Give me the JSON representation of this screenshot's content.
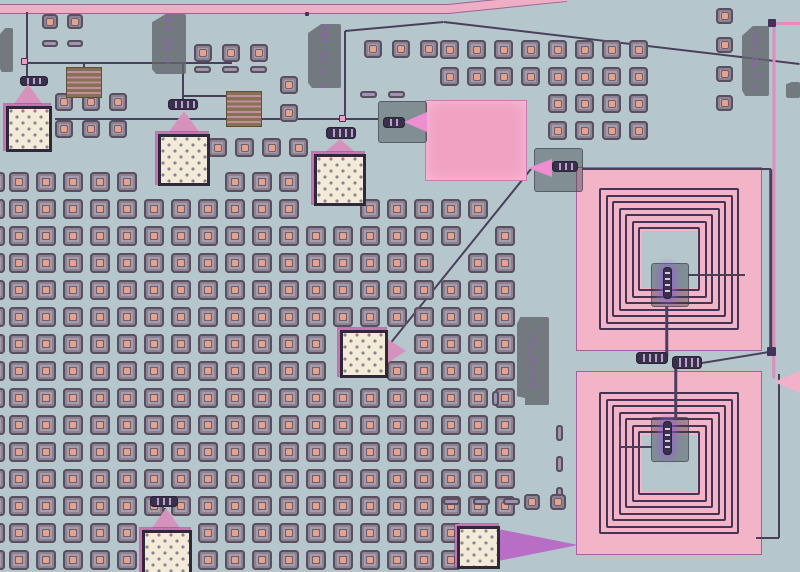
{
  "scene": {
    "kind": "chip-micrograph",
    "subject": "optical micrograph of a superconducting quantum circuit die"
  },
  "text_labels": {
    "resistor": "r = 50 ohm",
    "quad": "sq_quad"
  },
  "palette": {
    "bg": "#b5c7cd",
    "traceDark": "#4c3f5c",
    "tracePink": "#e08cbc",
    "feedPink": "#eeaec6",
    "pinkMetal": "#f3b4c7",
    "pinkRect": "#f1a2c2",
    "spiralLine": "#443557",
    "taperPink": "#d791bd",
    "taperViolet": "#b76ec4",
    "taperBright": "#ee8ed0",
    "taperPink2": "#f2b0ca",
    "padCream": "#f3ebd7",
    "padFrame": "#2e2838",
    "padRing": "#c873b4",
    "viaBody": "#756c7c",
    "viaDot": "#e7a28b",
    "tagGray": "#63676b",
    "tagText": "#8a63a8",
    "oliveResistor": "#867152"
  },
  "via_grids": [
    {
      "k": "sq",
      "x": 9,
      "y": 172,
      "dx": 27,
      "dy": 27,
      "cols": 13,
      "rows": 15,
      "w": 20,
      "h": 20,
      "skip": [
        [
          5,
          0
        ],
        [
          6,
          0
        ],
        [
          7,
          0
        ],
        [
          11,
          0
        ],
        [
          12,
          0
        ],
        [
          11,
          1
        ],
        [
          12,
          1
        ],
        [
          12,
          6
        ],
        [
          12,
          7
        ],
        [
          5,
          13
        ],
        [
          6,
          13
        ],
        [
          5,
          14
        ],
        [
          6,
          14
        ]
      ]
    },
    {
      "k": "sq",
      "x": -15,
      "y": 172,
      "dx": 27,
      "dy": 27,
      "cols": 1,
      "rows": 15,
      "w": 20,
      "h": 20,
      "skip": []
    },
    {
      "k": "sq",
      "x": 360,
      "y": 199,
      "dx": 27,
      "dy": 27,
      "cols": 6,
      "rows": 14,
      "w": 20,
      "h": 20,
      "skip": [
        [
          0,
          5
        ],
        [
          0,
          6
        ],
        [
          1,
          5
        ],
        [
          3,
          2
        ],
        [
          4,
          1
        ],
        [
          5,
          0
        ],
        [
          4,
          12
        ],
        [
          5,
          12
        ],
        [
          4,
          13
        ],
        [
          5,
          13
        ]
      ]
    },
    {
      "k": "sq",
      "x": 548,
      "y": 40,
      "dx": 27,
      "dy": 27,
      "cols": 4,
      "rows": 4,
      "w": 19,
      "h": 19,
      "skip": []
    },
    {
      "k": "sq",
      "x": 440,
      "y": 40,
      "dx": 27,
      "dy": 27,
      "cols": 4,
      "rows": 2,
      "w": 19,
      "h": 19,
      "skip": []
    },
    {
      "k": "sq",
      "x": 194,
      "y": 44,
      "dx": 28,
      "dy": 27,
      "cols": 3,
      "rows": 1,
      "w": 18,
      "h": 18,
      "skip": []
    },
    {
      "k": "bar",
      "x": 194,
      "y": 66,
      "dx": 28,
      "dy": 27,
      "cols": 3,
      "rows": 1,
      "w": 17,
      "h": 7,
      "skip": []
    },
    {
      "k": "sq",
      "x": 42,
      "y": 14,
      "dx": 25,
      "dy": 25,
      "cols": 2,
      "rows": 1,
      "w": 16,
      "h": 15,
      "skip": []
    },
    {
      "k": "bar",
      "x": 42,
      "y": 40,
      "dx": 25,
      "dy": 25,
      "cols": 2,
      "rows": 1,
      "w": 16,
      "h": 7,
      "skip": []
    },
    {
      "k": "sq",
      "x": 55,
      "y": 93,
      "dx": 27,
      "dy": 27,
      "cols": 3,
      "rows": 2,
      "w": 18,
      "h": 18,
      "skip": []
    },
    {
      "k": "sq",
      "x": 208,
      "y": 138,
      "dx": 27,
      "dy": 27,
      "cols": 4,
      "rows": 1,
      "w": 19,
      "h": 19,
      "skip": []
    },
    {
      "k": "bar",
      "x": 360,
      "y": 91,
      "dx": 28,
      "dy": 27,
      "cols": 2,
      "rows": 1,
      "w": 17,
      "h": 7,
      "skip": []
    },
    {
      "k": "sq",
      "x": 364,
      "y": 40,
      "dx": 28,
      "dy": 27,
      "cols": 3,
      "rows": 1,
      "w": 18,
      "h": 18,
      "skip": []
    },
    {
      "k": "sq",
      "x": 716,
      "y": 8,
      "dx": 27,
      "dy": 29,
      "cols": 1,
      "rows": 4,
      "w": 17,
      "h": 16,
      "skip": []
    },
    {
      "k": "vbar",
      "x": 556,
      "y": 425,
      "dx": 27,
      "dy": 31,
      "cols": 1,
      "rows": 3,
      "w": 7,
      "h": 16,
      "skip": []
    },
    {
      "k": "sq",
      "x": 280,
      "y": 76,
      "dx": 27,
      "dy": 28,
      "cols": 1,
      "rows": 2,
      "w": 18,
      "h": 18,
      "skip": []
    },
    {
      "k": "sq",
      "x": 524,
      "y": 494,
      "dx": 26,
      "dy": 27,
      "cols": 2,
      "rows": 1,
      "w": 16,
      "h": 16,
      "skip": []
    },
    {
      "k": "vbar",
      "x": 492,
      "y": 391,
      "dx": 27,
      "dy": 27,
      "cols": 1,
      "rows": 1,
      "w": 7,
      "h": 15,
      "skip": []
    },
    {
      "k": "bar",
      "x": 443,
      "y": 498,
      "dx": 30,
      "dy": 27,
      "cols": 3,
      "rows": 1,
      "w": 17,
      "h": 7,
      "skip": []
    }
  ],
  "traces_under": [
    {
      "x1": 0,
      "y1": 9,
      "x2": 449,
      "y2": 9,
      "w": 10,
      "c": "feed"
    },
    {
      "x1": 448,
      "y1": 9,
      "x2": 566,
      "y2": -3,
      "w": 10,
      "c": "feed"
    },
    {
      "x1": 26,
      "y1": 63,
      "x2": 232,
      "y2": 63,
      "w": 2,
      "c": "d"
    },
    {
      "x1": 55,
      "y1": 119,
      "x2": 378,
      "y2": 119,
      "w": 2,
      "c": "d"
    },
    {
      "x1": 345,
      "y1": 31,
      "x2": 345,
      "y2": 120,
      "w": 2,
      "c": "d"
    },
    {
      "x1": 345,
      "y1": 31,
      "x2": 444,
      "y2": 22,
      "w": 2,
      "c": "d"
    },
    {
      "x1": 444,
      "y1": 22,
      "x2": 800,
      "y2": 64,
      "w": 2,
      "c": "d"
    },
    {
      "x1": 27,
      "y1": 12,
      "x2": 27,
      "y2": 78,
      "w": 2,
      "c": "d"
    },
    {
      "x1": 183,
      "y1": 63,
      "x2": 183,
      "y2": 100,
      "w": 2,
      "c": "d"
    },
    {
      "x1": 183,
      "y1": 96,
      "x2": 228,
      "y2": 96,
      "w": 2,
      "c": "d"
    },
    {
      "x1": 84,
      "y1": 63,
      "x2": 84,
      "y2": 68,
      "w": 2,
      "c": "d"
    },
    {
      "x1": 385,
      "y1": 350,
      "x2": 531,
      "y2": 169,
      "w": 2,
      "c": "d"
    },
    {
      "x1": 165,
      "y1": 508,
      "x2": 165,
      "y2": 528,
      "w": 2,
      "c": "d"
    }
  ],
  "traces_over": [
    {
      "x1": 582,
      "y1": 169,
      "x2": 771,
      "y2": 169,
      "w": 2.5,
      "c": "d"
    },
    {
      "x1": 771,
      "y1": 169,
      "x2": 771,
      "y2": 352,
      "w": 2.5,
      "c": "d"
    },
    {
      "x1": 774,
      "y1": 23,
      "x2": 800,
      "y2": 23,
      "w": 3,
      "c": "p"
    },
    {
      "x1": 773.5,
      "y1": 24,
      "x2": 773.5,
      "y2": 352,
      "w": 3,
      "c": "p"
    },
    {
      "x1": 688,
      "y1": 275,
      "x2": 745,
      "y2": 275,
      "w": 2,
      "c": "d"
    },
    {
      "x1": 667,
      "y1": 306,
      "x2": 667,
      "y2": 356,
      "w": 2.5,
      "c": "d"
    },
    {
      "x1": 702,
      "y1": 363,
      "x2": 769,
      "y2": 352,
      "w": 2,
      "c": "d"
    },
    {
      "x1": 676,
      "y1": 368,
      "x2": 676,
      "y2": 420,
      "w": 2.5,
      "c": "d"
    },
    {
      "x1": 621,
      "y1": 447,
      "x2": 652,
      "y2": 447,
      "w": 2,
      "c": "d"
    },
    {
      "x1": 620,
      "y1": 425,
      "x2": 620,
      "y2": 447,
      "w": 2,
      "c": "d"
    },
    {
      "x1": 779,
      "y1": 374,
      "x2": 779,
      "y2": 538,
      "w": 2,
      "c": "d"
    },
    {
      "x1": 756,
      "y1": 538,
      "x2": 779,
      "y2": 538,
      "w": 2,
      "c": "d"
    },
    {
      "x1": 774,
      "y1": 352,
      "x2": 774,
      "y2": 378,
      "w": 2.5,
      "c": "p"
    }
  ],
  "rects": [
    {
      "x": 425,
      "y": 100,
      "w": 102,
      "h": 81,
      "cls": "pink-rect",
      "name": "capacitor-pad"
    },
    {
      "x": 66,
      "y": 67,
      "w": 36,
      "h": 31,
      "cls": "meander",
      "name": "meander-resistor"
    },
    {
      "x": 226,
      "y": 91,
      "w": 36,
      "h": 36,
      "cls": "meander",
      "name": "meander-resistor"
    }
  ],
  "gblocks": [
    {
      "x": 378,
      "y": 101,
      "w": 49,
      "h": 42,
      "name": "junction-launcher-block"
    },
    {
      "x": 534,
      "y": 148,
      "w": 49,
      "h": 44,
      "name": "junction-launcher-block"
    },
    {
      "x": 651,
      "y": 263,
      "w": 38,
      "h": 44,
      "name": "spiral-center-block"
    },
    {
      "x": 651,
      "y": 417,
      "w": 38,
      "h": 45,
      "name": "spiral-center-block"
    }
  ],
  "spirals": [
    {
      "x": 576,
      "y": 167,
      "w": 186,
      "h": 184,
      "turns": 7,
      "gap": 6.5,
      "padl": 23,
      "padt": 21,
      "name": "spiral-inductor-top"
    },
    {
      "x": 576,
      "y": 371,
      "w": 186,
      "h": 184,
      "turns": 7,
      "gap": 6.5,
      "padl": 23,
      "padt": 21,
      "name": "spiral-inductor-bottom"
    }
  ],
  "chains": [
    {
      "x": 20,
      "y": 76,
      "w": 28,
      "h": 10,
      "o": "h"
    },
    {
      "x": 168,
      "y": 99,
      "w": 30,
      "h": 11,
      "o": "h"
    },
    {
      "x": 326,
      "y": 127,
      "w": 30,
      "h": 12,
      "o": "h"
    },
    {
      "x": 383,
      "y": 117,
      "w": 22,
      "h": 11,
      "o": "h"
    },
    {
      "x": 552,
      "y": 161,
      "w": 26,
      "h": 11,
      "o": "h"
    },
    {
      "x": 636,
      "y": 352,
      "w": 32,
      "h": 12,
      "o": "h"
    },
    {
      "x": 672,
      "y": 356,
      "w": 30,
      "h": 13,
      "o": "h"
    },
    {
      "x": 663,
      "y": 267,
      "w": 9,
      "h": 32,
      "o": "v",
      "glow": true
    },
    {
      "x": 663,
      "y": 421,
      "w": 9,
      "h": 34,
      "o": "v",
      "glow": true
    },
    {
      "x": 150,
      "y": 496,
      "w": 28,
      "h": 11,
      "o": "h"
    }
  ],
  "tapers": [
    {
      "x": 13,
      "y": 84,
      "w": 30,
      "h": 21,
      "s": "up",
      "c": "taperPink"
    },
    {
      "x": 168,
      "y": 111,
      "w": 32,
      "h": 22,
      "s": "up",
      "c": "taperPink"
    },
    {
      "x": 324,
      "y": 139,
      "w": 32,
      "h": 14,
      "s": "up",
      "c": "taperPink"
    },
    {
      "x": 386,
      "y": 338,
      "w": 20,
      "h": 26,
      "s": "right",
      "c": "taperPink"
    },
    {
      "x": 152,
      "y": 508,
      "w": 28,
      "h": 20,
      "s": "up",
      "c": "taperPink"
    },
    {
      "x": 498,
      "y": 529,
      "w": 80,
      "h": 32,
      "s": "right",
      "c": "taperViolet"
    },
    {
      "x": 404,
      "y": 112,
      "w": 23,
      "h": 20,
      "s": "wideright",
      "c": "taperBright"
    },
    {
      "x": 528,
      "y": 159,
      "w": 24,
      "h": 18,
      "s": "wideright",
      "c": "taperBright"
    },
    {
      "x": 774,
      "y": 371,
      "w": 26,
      "h": 22,
      "s": "wideright",
      "c": "taperPink2"
    }
  ],
  "pads": [
    {
      "x": 4,
      "y": 104,
      "w": 46,
      "h": 46
    },
    {
      "x": 156,
      "y": 132,
      "w": 52,
      "h": 52
    },
    {
      "x": 312,
      "y": 152,
      "w": 52,
      "h": 52
    },
    {
      "x": 338,
      "y": 328,
      "w": 48,
      "h": 48
    },
    {
      "x": 140,
      "y": 528,
      "w": 50,
      "h": 50
    },
    {
      "x": 455,
      "y": 524,
      "w": 43,
      "h": 43
    }
  ],
  "tags": [
    {
      "x": 0,
      "y": 28,
      "w": 13,
      "h": 44,
      "t": null
    },
    {
      "x": 152,
      "y": 14,
      "w": 34,
      "h": 60,
      "t": "resistor",
      "flip": true
    },
    {
      "x": 308,
      "y": 24,
      "w": 33,
      "h": 64,
      "t": "resistor",
      "flip": true
    },
    {
      "x": 742,
      "y": 26,
      "w": 27,
      "h": 70,
      "t": "resistor",
      "flip": true
    },
    {
      "x": 786,
      "y": 82,
      "w": 14,
      "h": 16,
      "t": null
    },
    {
      "x": 517,
      "y": 317,
      "w": 32,
      "h": 88,
      "t": "quad",
      "flip": false
    }
  ],
  "dots": [
    {
      "x": 21,
      "y": 58,
      "s": 7,
      "c": "pink"
    },
    {
      "x": 339,
      "y": 115,
      "s": 7,
      "c": "pink"
    },
    {
      "x": 768,
      "y": 19,
      "s": 8,
      "c": "dark"
    },
    {
      "x": 767,
      "y": 347,
      "s": 9,
      "c": "dark"
    },
    {
      "x": 305,
      "y": 12,
      "s": 4,
      "c": "dark"
    }
  ]
}
